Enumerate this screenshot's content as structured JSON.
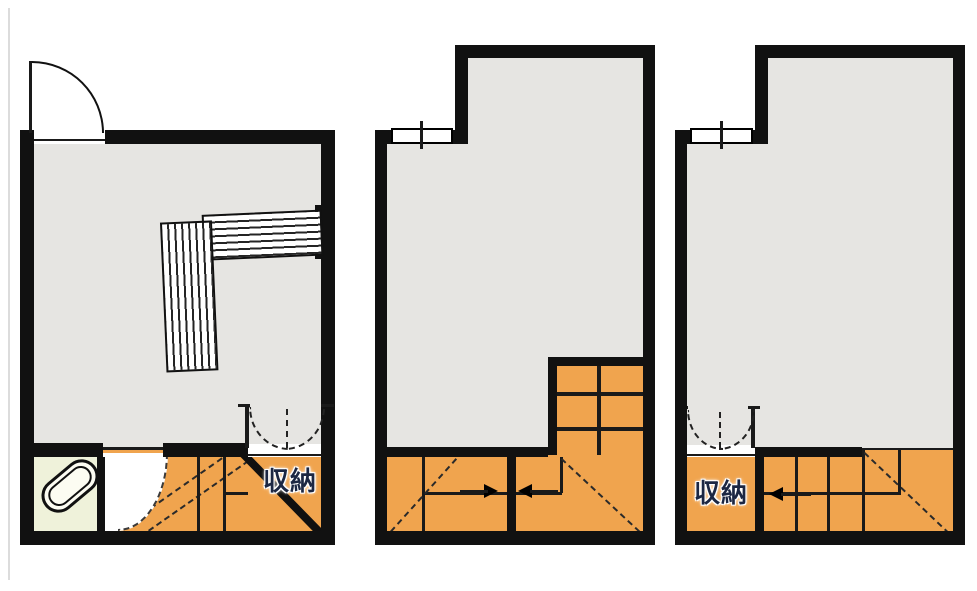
{
  "page": {
    "background": "#ffffff",
    "type": "architectural-floor-plan",
    "plans_count": 3
  },
  "colors": {
    "wall": "#111111",
    "room_floor": "#e6e5e2",
    "stairs_orange": "#f0a44e",
    "bathroom_floor": "#eff2da",
    "label_text": "#1c2743",
    "label_halo": "#ffffff"
  },
  "labels": {
    "storage_plan1": "収納",
    "storage_plan3": "収納"
  },
  "plans": [
    {
      "id": "plan-1",
      "elements": [
        "entrance-door-swing",
        "l-shaped-counter",
        "bathroom",
        "bathtub",
        "hall-door-swing",
        "staircase",
        "storage-closet",
        "double-closet-door",
        "storage-label"
      ]
    },
    {
      "id": "plan-2",
      "elements": [
        "sliding-window",
        "upper-stair-grid",
        "stair-flight-left",
        "stair-flight-right",
        "arrow-right",
        "arrow-left"
      ]
    },
    {
      "id": "plan-3",
      "elements": [
        "sliding-window",
        "storage-closet",
        "double-closet-door",
        "storage-label",
        "stair-flight",
        "arrow-left"
      ]
    }
  ]
}
